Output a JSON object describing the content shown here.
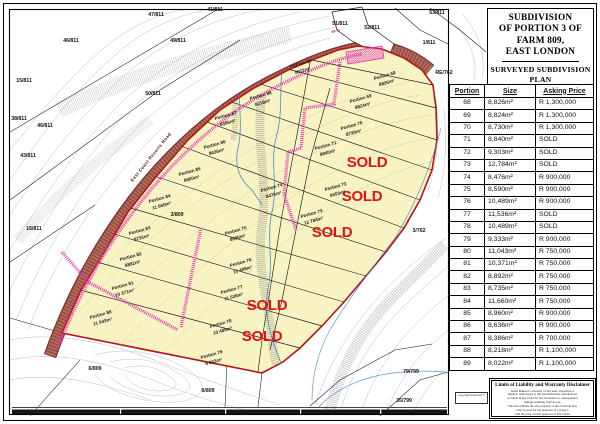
{
  "sheet": {
    "title_lines": [
      "SUBDIVISION",
      "OF PORTION 3 OF",
      "FARM 809,",
      "EAST LONDON"
    ],
    "subtitle_lines": [
      "SURVEYED SUBDIVISION",
      "PLAN"
    ]
  },
  "table": {
    "headers": [
      "Portion",
      "Size",
      "Asking Price"
    ],
    "rows": [
      {
        "portion": "68",
        "size": "8,826m²",
        "price": "R 1,300,000"
      },
      {
        "portion": "69",
        "size": "8,824m²",
        "price": "R 1,300,000"
      },
      {
        "portion": "70",
        "size": "8,730m²",
        "price": "R 1,300,000"
      },
      {
        "portion": "71",
        "size": "8,840m²",
        "price": "SOLD"
      },
      {
        "portion": "72",
        "size": "9,303m²",
        "price": "SOLD"
      },
      {
        "portion": "73",
        "size": "12,784m²",
        "price": "SOLD"
      },
      {
        "portion": "74",
        "size": "8,476m²",
        "price": "R 900,000"
      },
      {
        "portion": "75",
        "size": "8,590m²",
        "price": "R 900,000"
      },
      {
        "portion": "76",
        "size": "10,489m²",
        "price": "R 900,000"
      },
      {
        "portion": "77",
        "size": "11,536m²",
        "price": "SOLD"
      },
      {
        "portion": "78",
        "size": "10,489m²",
        "price": "SOLD"
      },
      {
        "portion": "79",
        "size": "9,333m²",
        "price": "R 900,000"
      },
      {
        "portion": "80",
        "size": "11,043m²",
        "price": "R 750,000"
      },
      {
        "portion": "81",
        "size": "10,371m²",
        "price": "R 750,000"
      },
      {
        "portion": "82",
        "size": "8,892m²",
        "price": "R 750,000"
      },
      {
        "portion": "83",
        "size": "8,735m²",
        "price": "R 750,000"
      },
      {
        "portion": "84",
        "size": "11,660m²",
        "price": "R 750,000"
      },
      {
        "portion": "85",
        "size": "8,960m²",
        "price": "R 900,000"
      },
      {
        "portion": "86",
        "size": "8,636m²",
        "price": "R 900,000"
      },
      {
        "portion": "87",
        "size": "8,386m²",
        "price": "R 700,000"
      },
      {
        "portion": "88",
        "size": "8,218m²",
        "price": "R 1,100,000"
      },
      {
        "portion": "89",
        "size": "8,022m²",
        "price": "R 1,100,000"
      }
    ]
  },
  "map": {
    "road_label": "East Coast Resorts Road",
    "bearing_label": "46.71",
    "sold_text": "SOLD",
    "colors": {
      "sold_red": "#e31212",
      "boundary_red": "#b51616",
      "parcel_yellow": "#f7f3c3",
      "servitude_magenta": "#e832b4"
    },
    "portions": [
      {
        "name": "Portion 68",
        "size": "8826m²",
        "x": 385,
        "y": 77
      },
      {
        "name": "Portion 69",
        "size": "8824m²",
        "x": 361,
        "y": 100
      },
      {
        "name": "Portion 70",
        "size": "8730m²",
        "x": 352,
        "y": 127
      },
      {
        "name": "Portion 71",
        "size": "8840m²",
        "x": 326,
        "y": 147
      },
      {
        "name": "Portion 72",
        "size": "9303m²",
        "x": 336,
        "y": 188
      },
      {
        "name": "Portion 73",
        "size": "12 784m²",
        "x": 312,
        "y": 215
      },
      {
        "name": "Portion 74",
        "size": "8476m²",
        "x": 272,
        "y": 189
      },
      {
        "name": "Portion 75",
        "size": "8590m²",
        "x": 236,
        "y": 232
      },
      {
        "name": "Portion 76",
        "size": "10 489m²",
        "x": 241,
        "y": 264
      },
      {
        "name": "Portion 77",
        "size": "11 536m²",
        "x": 232,
        "y": 291
      },
      {
        "name": "Portion 78",
        "size": "10 489m²",
        "x": 221,
        "y": 325
      },
      {
        "name": "Portion 79",
        "size": "9 333m²",
        "x": 212,
        "y": 356
      },
      {
        "name": "Portion 80",
        "size": "11 043m²",
        "x": 101,
        "y": 316
      },
      {
        "name": "Portion 81",
        "size": "10 371m²",
        "x": 123,
        "y": 287
      },
      {
        "name": "Portion 82",
        "size": "8892m²",
        "x": 131,
        "y": 258
      },
      {
        "name": "Portion 83",
        "size": "8735m²",
        "x": 140,
        "y": 232
      },
      {
        "name": "Portion 84",
        "size": "11 660m²",
        "x": 160,
        "y": 200
      },
      {
        "name": "Portion 85",
        "size": "8960m²",
        "x": 190,
        "y": 173
      },
      {
        "name": "Portion 86",
        "size": "8636m²",
        "x": 215,
        "y": 146
      },
      {
        "name": "Portion 87",
        "size": "8386m²",
        "x": 226,
        "y": 117
      },
      {
        "name": "Portion 88",
        "size": "8218m²",
        "x": 261,
        "y": 97
      },
      {
        "name": "Portion 89",
        "size": "8022m²",
        "x": 301,
        "y": 65
      }
    ],
    "sold_marks": [
      {
        "x": 367,
        "y": 167
      },
      {
        "x": 362,
        "y": 201
      },
      {
        "x": 332,
        "y": 237
      },
      {
        "x": 267,
        "y": 310
      },
      {
        "x": 262,
        "y": 341
      }
    ],
    "neighbors": [
      {
        "label": "47/811",
        "x": 156,
        "y": 16
      },
      {
        "label": "41/811",
        "x": 215,
        "y": 11
      },
      {
        "label": "53/811",
        "x": 437,
        "y": 14
      },
      {
        "label": "51/811",
        "x": 340,
        "y": 25
      },
      {
        "label": "52/811",
        "x": 372,
        "y": 29
      },
      {
        "label": "1/811",
        "x": 429,
        "y": 44
      },
      {
        "label": "46/811",
        "x": 71,
        "y": 42
      },
      {
        "label": "49/811",
        "x": 178,
        "y": 42
      },
      {
        "label": "15/811",
        "x": 24,
        "y": 82
      },
      {
        "label": "50/811",
        "x": 153,
        "y": 95
      },
      {
        "label": "38/811",
        "x": 19,
        "y": 120
      },
      {
        "label": "46/811",
        "x": 45,
        "y": 127
      },
      {
        "label": "43/811",
        "x": 28,
        "y": 157
      },
      {
        "label": "16/811",
        "x": 34,
        "y": 230
      },
      {
        "label": "3/809",
        "x": 177,
        "y": 216
      },
      {
        "label": "6/809",
        "x": 95,
        "y": 370
      },
      {
        "label": "6/809",
        "x": 208,
        "y": 392
      },
      {
        "label": "79/799",
        "x": 411,
        "y": 373
      },
      {
        "label": "35/799",
        "x": 404,
        "y": 402
      },
      {
        "label": "3/762",
        "x": 419,
        "y": 232
      },
      {
        "label": "RE/762",
        "x": 444,
        "y": 74
      }
    ]
  },
  "disclaimer": {
    "title": "Limits of Liability and Warranty Disclaimer",
    "lines": [
      "Seller makes no warranty of any kind, expressed or",
      "implied, with regard to the data illustrated, and shall not",
      "be liable in any event for any incidental or consequential",
      "damage resulting from its use.",
      "The data remains the sole property of this Client & may",
      "only be used for the purposes of a project,",
      "with the prior written approval of this Client."
    ]
  },
  "copyright": "Copyright Reserved ©"
}
